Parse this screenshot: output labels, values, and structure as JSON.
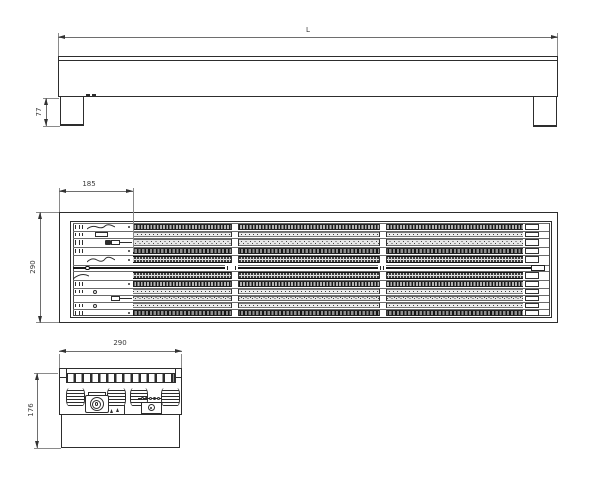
{
  "drawing": {
    "kind": "three-view technical drawing of linear grate heater unit",
    "colors": {
      "paper": "#ffffff",
      "object_line": "#2d2d2d",
      "dim_line": "#6e6e6e",
      "dim_text": "#3a3a3a",
      "band_gray": "#b5b5b5",
      "band_dark": "#3e3e3e",
      "shaft": "#161616"
    },
    "front_view": {
      "name": "front elevation",
      "dims": {
        "length": "L",
        "leg_height": "77"
      }
    },
    "plan_view": {
      "name": "top plan",
      "dims": {
        "lead_in": "185",
        "width": "290"
      },
      "support_gaps_x": [
        231,
        379
      ],
      "rows": [
        {
          "y": 223,
          "h": 7,
          "type": "teeth",
          "left": [
            "bars",
            "wave",
            "dot"
          ]
        },
        {
          "y": 231,
          "h": 6,
          "type": "dots",
          "left": [
            "bars",
            "box"
          ]
        },
        {
          "y": 238,
          "h": 8,
          "type": "dashx",
          "left": [
            "bars",
            "blob",
            "connector"
          ]
        },
        {
          "y": 247,
          "h": 7,
          "type": "arcs",
          "left": [
            "bars",
            "dot"
          ]
        },
        {
          "y": 255,
          "h": 8,
          "type": "dense",
          "left": [
            "wave",
            "dot"
          ]
        },
        {
          "y": 265,
          "h": 5,
          "type": "shaft",
          "left": []
        },
        {
          "y": 271,
          "h": 8,
          "type": "dense",
          "left": [
            "curve"
          ]
        },
        {
          "y": 280,
          "h": 7,
          "type": "teeth",
          "left": [
            "bars",
            "dot"
          ]
        },
        {
          "y": 288,
          "h": 6,
          "type": "dots",
          "left": [
            "bars",
            "circle"
          ]
        },
        {
          "y": 295,
          "h": 6,
          "type": "dashx",
          "left": [
            "connector"
          ]
        },
        {
          "y": 302,
          "h": 6,
          "type": "dots",
          "left": [
            "bars",
            "circle"
          ]
        },
        {
          "y": 309,
          "h": 7,
          "type": "arcs",
          "left": [
            "bars",
            "dot"
          ]
        }
      ]
    },
    "side_view": {
      "name": "side section",
      "dims": {
        "width": "290",
        "height": "176"
      },
      "fins": [
        {
          "x": 66,
          "w": 19
        },
        {
          "x": 107,
          "w": 19
        },
        {
          "x": 130,
          "w": 18
        },
        {
          "x": 161,
          "w": 19
        }
      ],
      "rail_tooth_count": 13
    }
  }
}
